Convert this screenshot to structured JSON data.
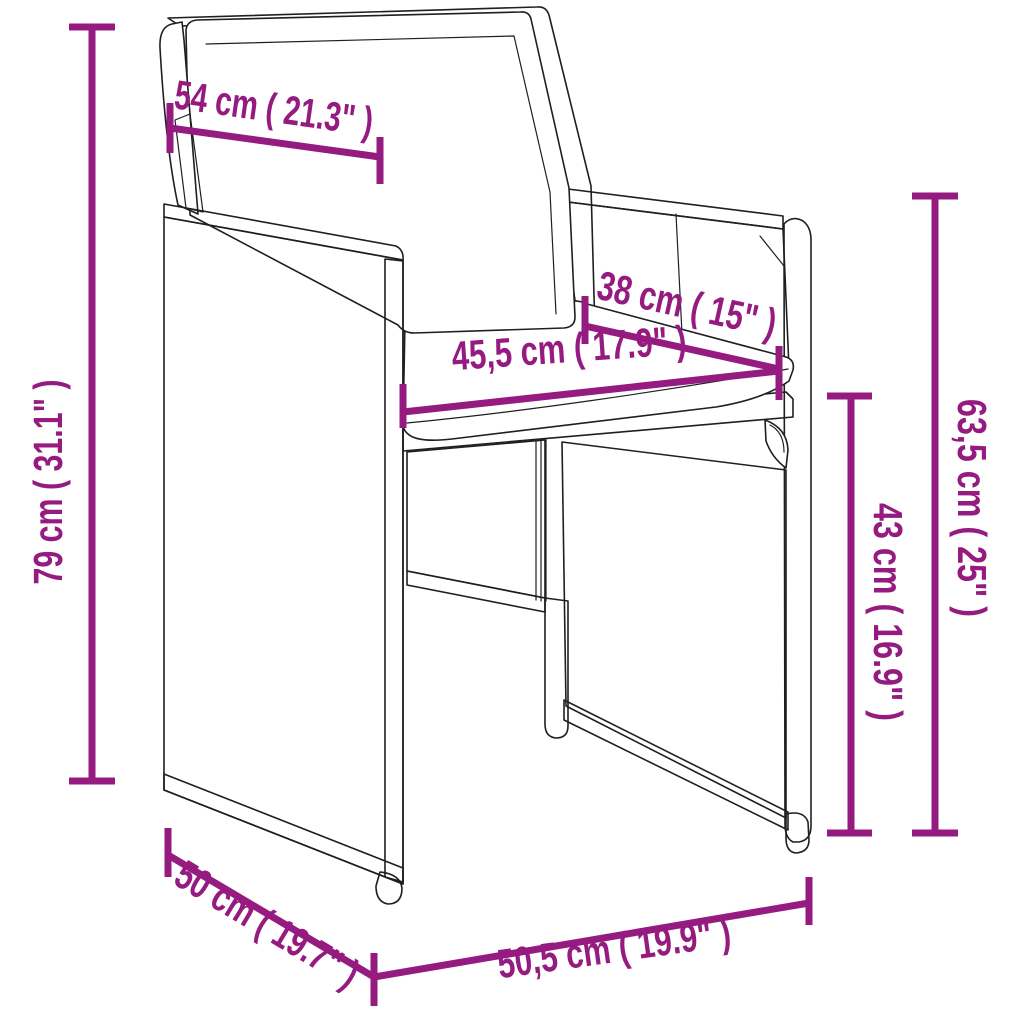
{
  "page": {
    "width": 1024,
    "height": 1024,
    "background": "#ffffff"
  },
  "diagram": {
    "type": "furniture-dimension-line-drawing",
    "subject": "poly rattan cube garden chair with back and seat cushions",
    "accent_color": "#951b81",
    "line_color": "#1f1f1f",
    "dimensions": [
      {
        "id": "back-cushion-width",
        "label": "54 cm ( 21.3\" )",
        "orientation": "diagonal-top"
      },
      {
        "id": "total-back-height",
        "label": "79 cm ( 31.1\" )",
        "orientation": "vertical-left"
      },
      {
        "id": "seat-depth",
        "label": "38 cm ( 15\" )",
        "orientation": "diagonal-seat-right"
      },
      {
        "id": "seat-width",
        "label": "45,5 cm ( 17.9\" )",
        "orientation": "diagonal-seat-front"
      },
      {
        "id": "seat-height",
        "label": "43 cm ( 16.9\" )",
        "orientation": "vertical-right-inner"
      },
      {
        "id": "armrest-height",
        "label": "63,5 cm ( 25\" )",
        "orientation": "vertical-right-outer"
      },
      {
        "id": "base-depth",
        "label": "50 cm ( 19.7\" )",
        "orientation": "diagonal-bottom-left"
      },
      {
        "id": "base-width",
        "label": "50,5 cm ( 19.9\" )",
        "orientation": "diagonal-bottom-front"
      }
    ]
  }
}
